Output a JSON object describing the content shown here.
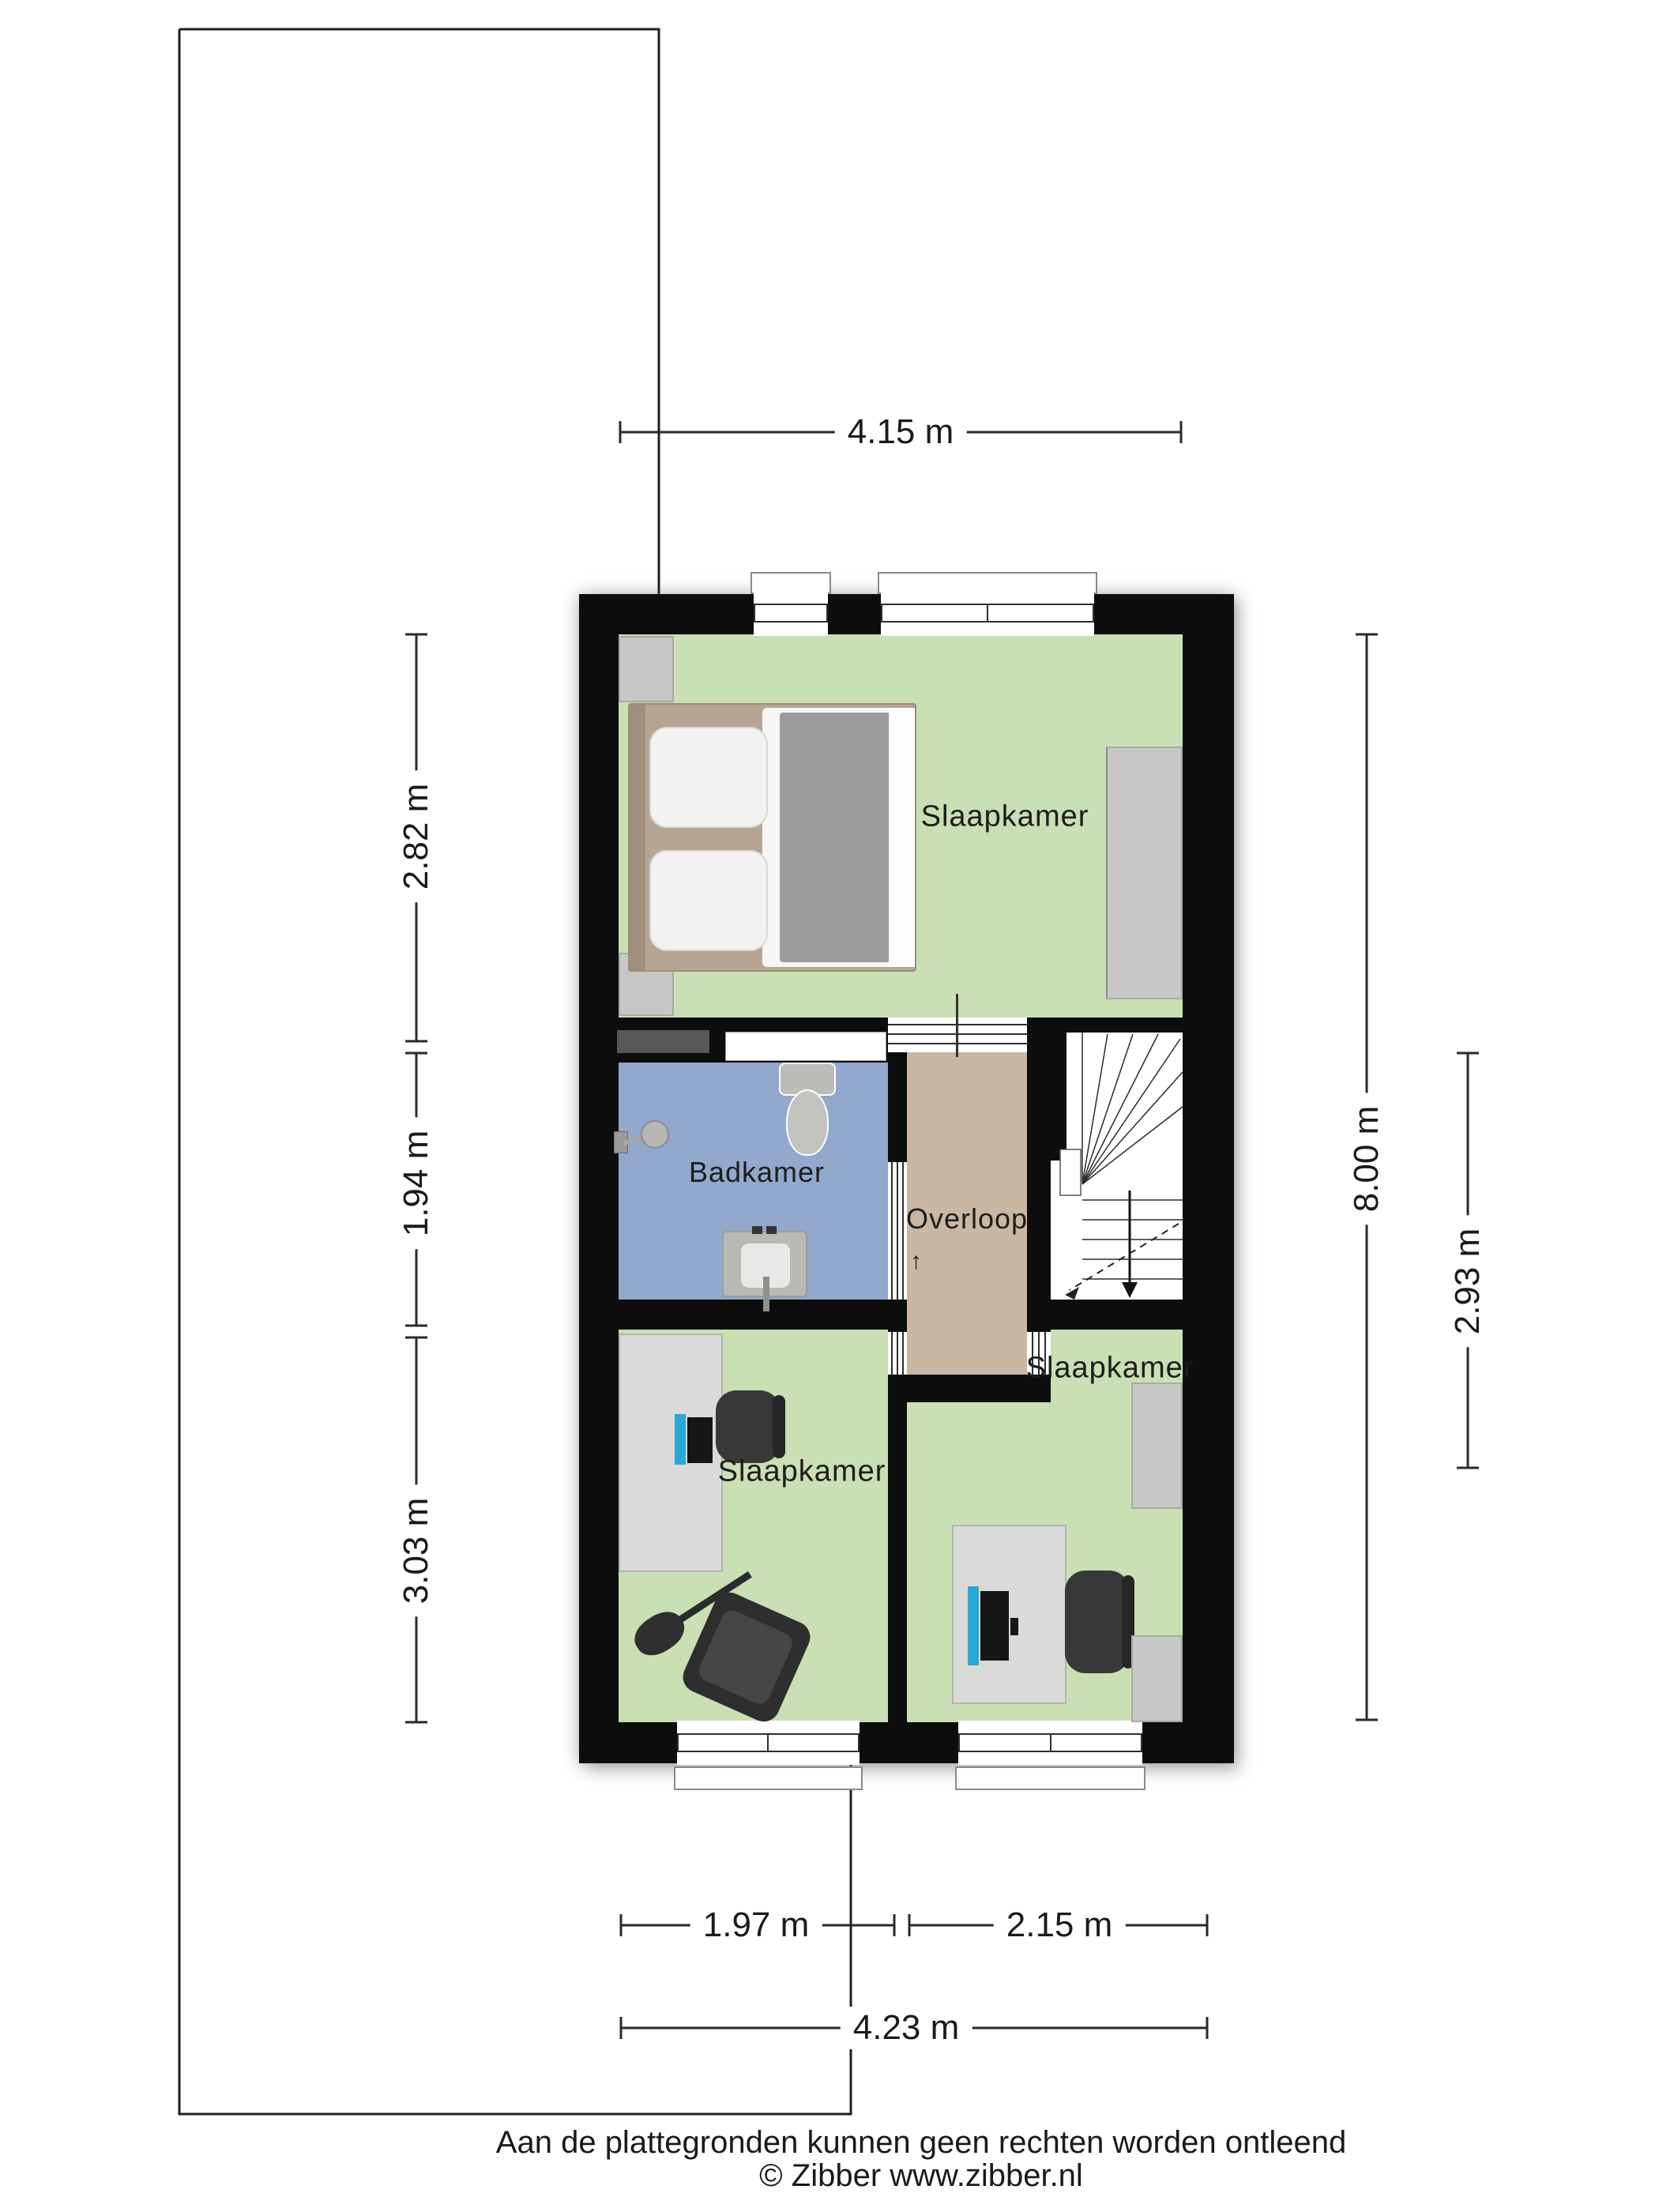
{
  "rooms": {
    "bedroom_top": {
      "label": "Slaapkamer"
    },
    "bathroom": {
      "label": "Badkamer"
    },
    "landing": {
      "label": "Overloop"
    },
    "bedroom_left": {
      "label": "Slaapkamer"
    },
    "bedroom_right": {
      "label": "Slaapkamer"
    }
  },
  "dimensions": {
    "top_width": {
      "label": "4.15 m"
    },
    "left_top": {
      "label": "2.82 m"
    },
    "left_middle": {
      "label": "1.94 m"
    },
    "left_bottom": {
      "label": "3.03 m"
    },
    "right_full": {
      "label": "8.00 m"
    },
    "right_partial": {
      "label": "2.93 m"
    },
    "bottom_left": {
      "label": "1.97 m"
    },
    "bottom_right": {
      "label": "2.15 m"
    },
    "bottom_full": {
      "label": "4.23 m"
    }
  },
  "icons": {
    "stairs_up_arrow": "↑"
  },
  "footer": {
    "disclaimer": "Aan de plattegronden kunnen geen rechten worden ontleend",
    "copyright": "© Zibber www.zibber.nl"
  },
  "colors": {
    "wall": "#0d0d0d",
    "bedroom_floor": "#c9dfb4",
    "bathroom_floor": "#92a8cc",
    "landing_floor": "#c9b7a3",
    "furniture_gray": "#c7c7c5",
    "desk_gray": "#dadad8",
    "chair_dark": "#383838",
    "monitor_accent": "#29a8d8",
    "dimension_line": "#2a2a2a"
  }
}
